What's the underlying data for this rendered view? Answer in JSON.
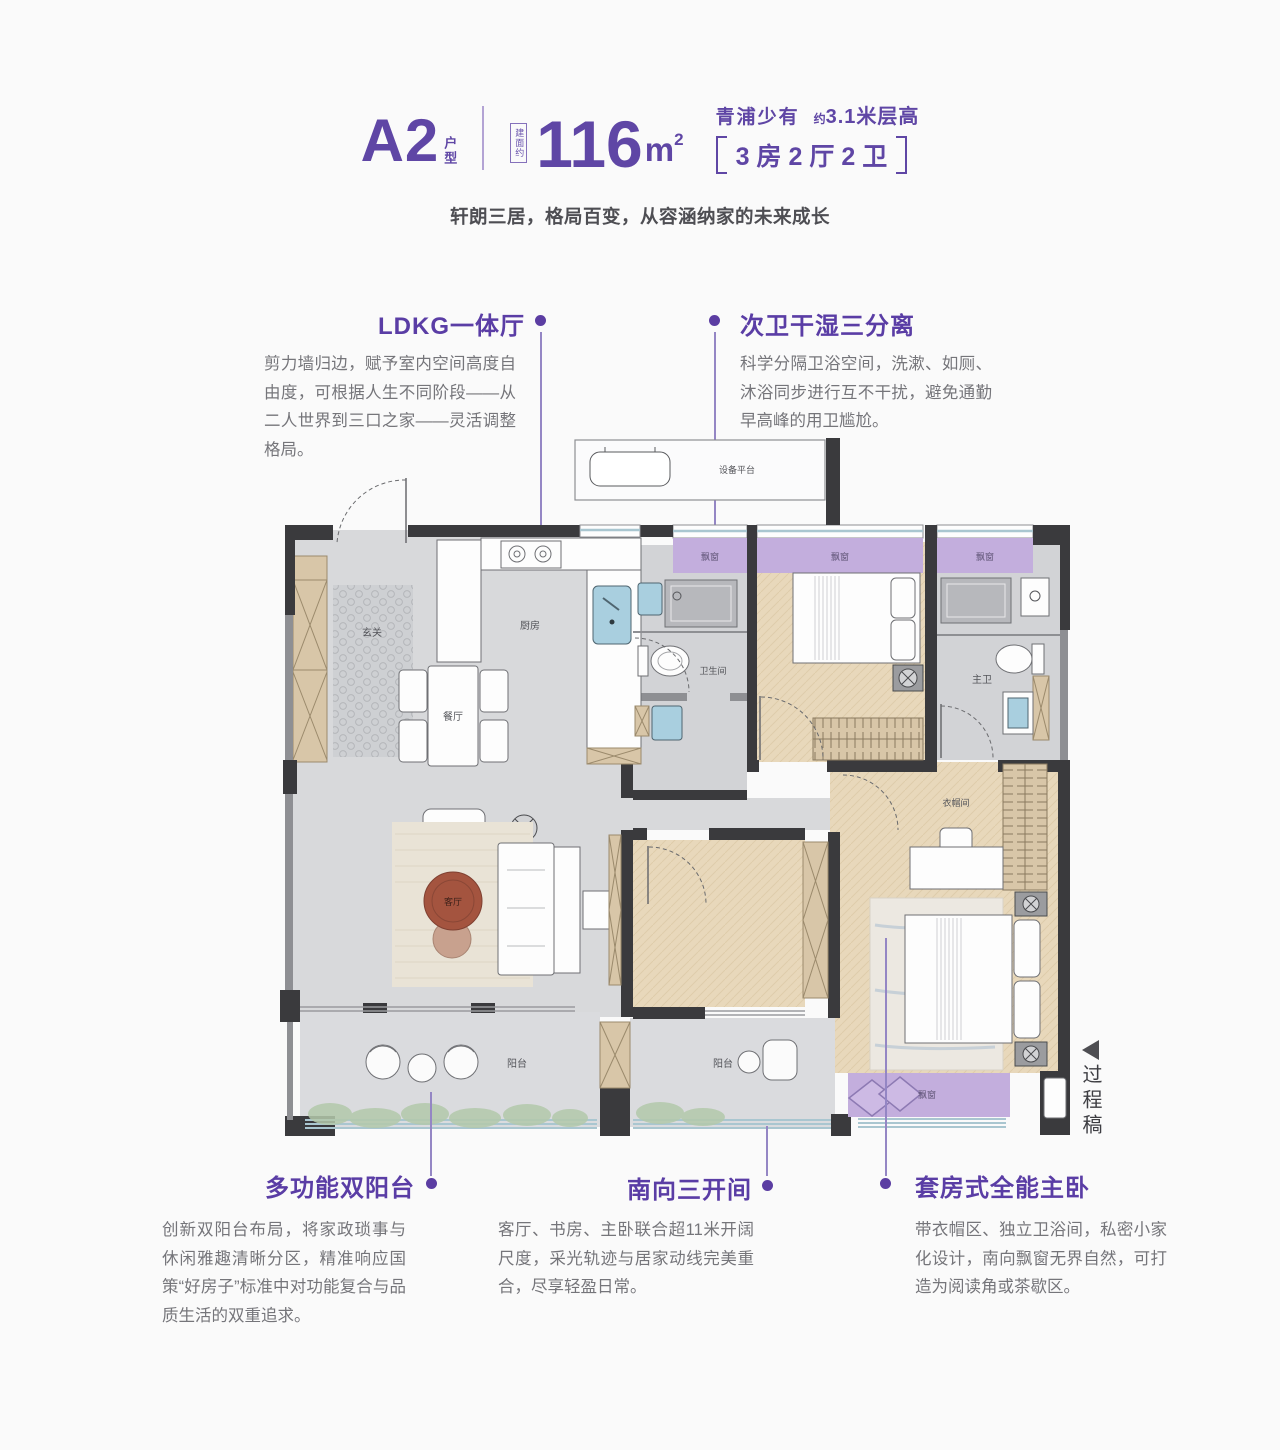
{
  "header": {
    "code": "A2",
    "code_suffix": "户型",
    "area_label": "建面约",
    "area_number": "116",
    "area_unit": "m",
    "area_sup": "2",
    "scarcity": "青浦少有",
    "height_prefix": "约",
    "height_value": "3.1米层高",
    "layout": "3房2厅2卫",
    "tagline": "轩朗三居，格局百变，从容涵纳家的未来成长"
  },
  "callouts": {
    "ldk": {
      "title": "LDKG一体厅",
      "body": "剪力墙归边，赋予室内空间高度自由度，可根据人生不同阶段——从二人世界到三口之家——灵活调整格局。"
    },
    "bath": {
      "title": "次卫干湿三分离",
      "body": "科学分隔卫浴空间，洗漱、如厕、沐浴同步进行互不干扰，避免通勤早高峰的用卫尴尬。"
    },
    "balcony": {
      "title": "多功能双阳台",
      "body": "创新双阳台布局，将家政琐事与休闲雅趣清晰分区，精准响应国策“好房子”标准中对功能复合与品质生活的双重追求。"
    },
    "south": {
      "title": "南向三开间",
      "body": "客厅、书房、主卧联合超11米开阔尺度，采光轨迹与居家动线完美重合，尽享轻盈日常。"
    },
    "master": {
      "title": "套房式全能主卧",
      "body": "带衣帽区、独立卫浴间，私密小家化设计，南向飘窗无界自然，可打造为阅读角或茶歇区。"
    }
  },
  "floor_plan": {
    "rooms": {
      "entry": "玄关",
      "dining": "餐厅",
      "kitchen": "厨房",
      "living": "客厅",
      "bathroom": "卫生间",
      "master_bath": "主卫",
      "closet": "衣帽间",
      "balcony_left": "阳台",
      "balcony_mid": "阳台",
      "bay1": "飘窗",
      "bay2": "飘窗",
      "bay3": "飘窗",
      "bay_south": "飘窗",
      "equipment": "设备平台"
    },
    "colors": {
      "accent": "#5f46a5",
      "bay_purple": "#c3aedd",
      "wall_dark": "#3a3a3d",
      "wood": "#e8d8bb",
      "marble": "#d8d9db"
    }
  },
  "side_note": {
    "text": "过程稿"
  }
}
